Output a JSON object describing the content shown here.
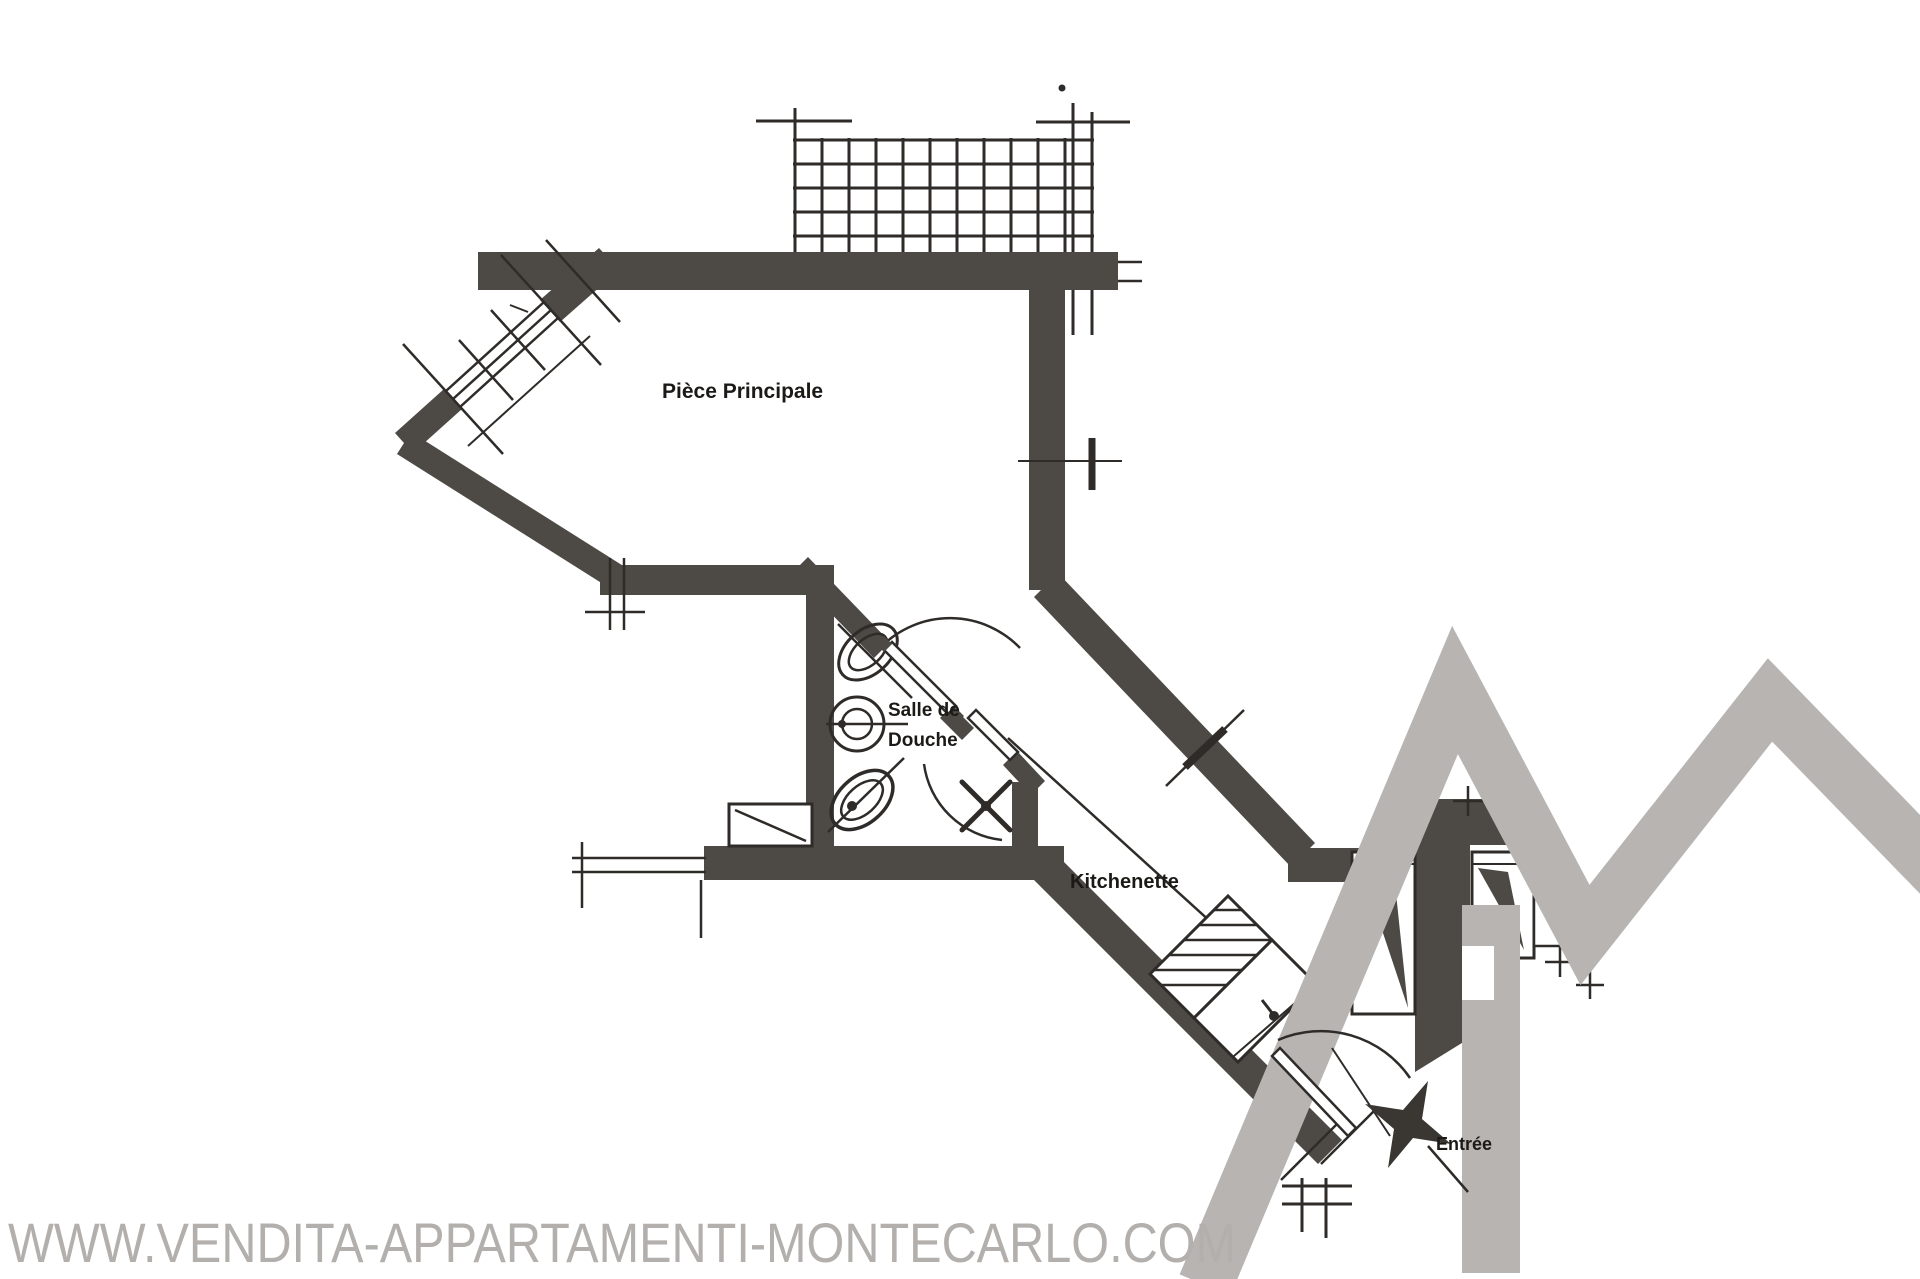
{
  "title": "Apartment floor plan - Monte Carlo",
  "rooms": {
    "main_room": "Pièce Principale",
    "shower_line1": "Salle de",
    "shower_line2": "Douche",
    "kitchenette": "Kitchenette",
    "entrance": "Entrée"
  },
  "watermark": {
    "text": "WWW.VENDITA-APPARTAMENTI-MONTECARLO.COM",
    "color": "#b2afac"
  },
  "logo": {
    "shape": "house-roof-monogram",
    "color": "#b7b4b1"
  },
  "colors": {
    "wall": "#4d4944",
    "line": "#2e2b28",
    "label": "#1c1a17",
    "paper": "#ffffff"
  }
}
